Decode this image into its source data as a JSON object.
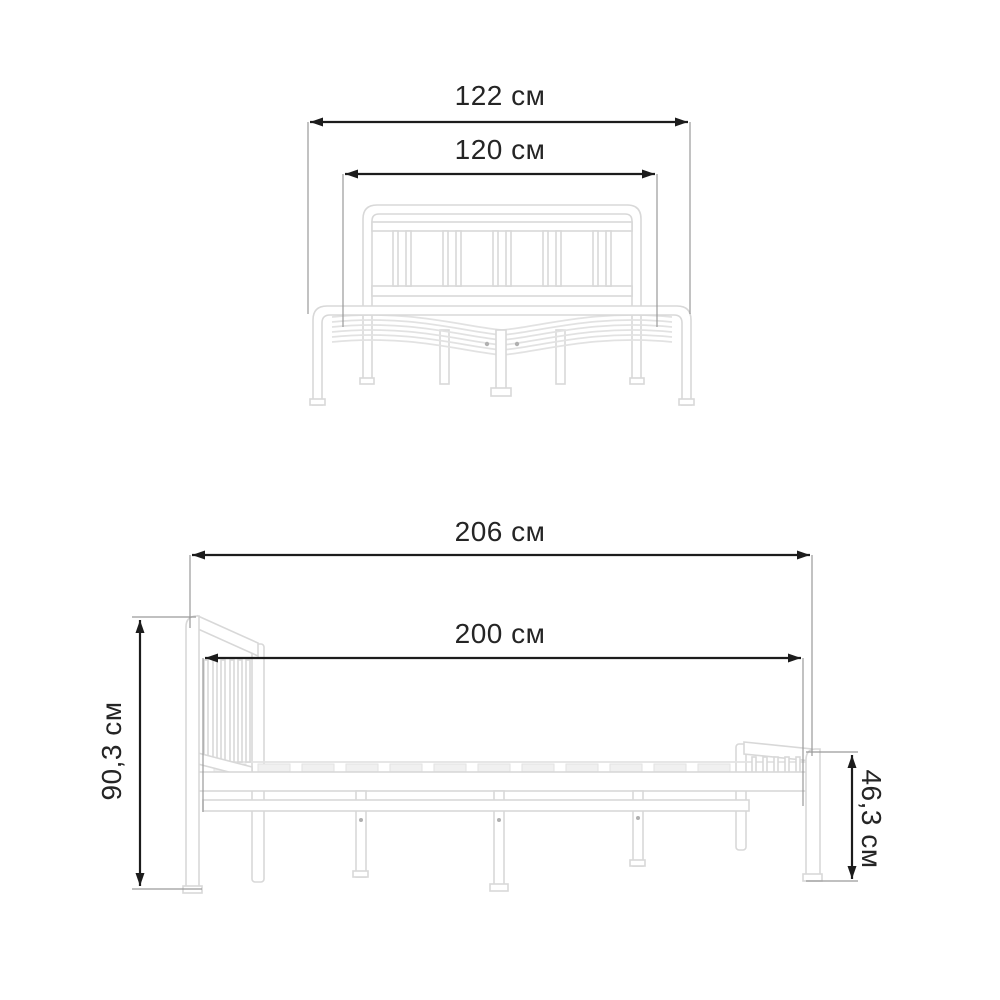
{
  "dimensions": {
    "front_overall_width": {
      "label": "122 см",
      "value": "122",
      "unit": "см"
    },
    "front_inner_width": {
      "label": "120 см",
      "value": "120",
      "unit": "см"
    },
    "side_overall_length": {
      "label": "206 см",
      "value": "206",
      "unit": "см"
    },
    "side_inner_length": {
      "label": "200 см",
      "value": "200",
      "unit": "см"
    },
    "headboard_height": {
      "label": "90,3 см",
      "value": "90,3",
      "unit": "см"
    },
    "footboard_height": {
      "label": "46,3 см",
      "value": "46,3",
      "unit": "см"
    }
  },
  "colors": {
    "background": "#ffffff",
    "dimension-line": "#1c1c1c",
    "extension-line": "#9a9a9a",
    "label-text": "#252525",
    "bed-outline": "#d8d8d8",
    "bed-fill": "#ffffff",
    "slat-line": "#e2e2e2",
    "slat-mark": "#f0f0f0"
  }
}
